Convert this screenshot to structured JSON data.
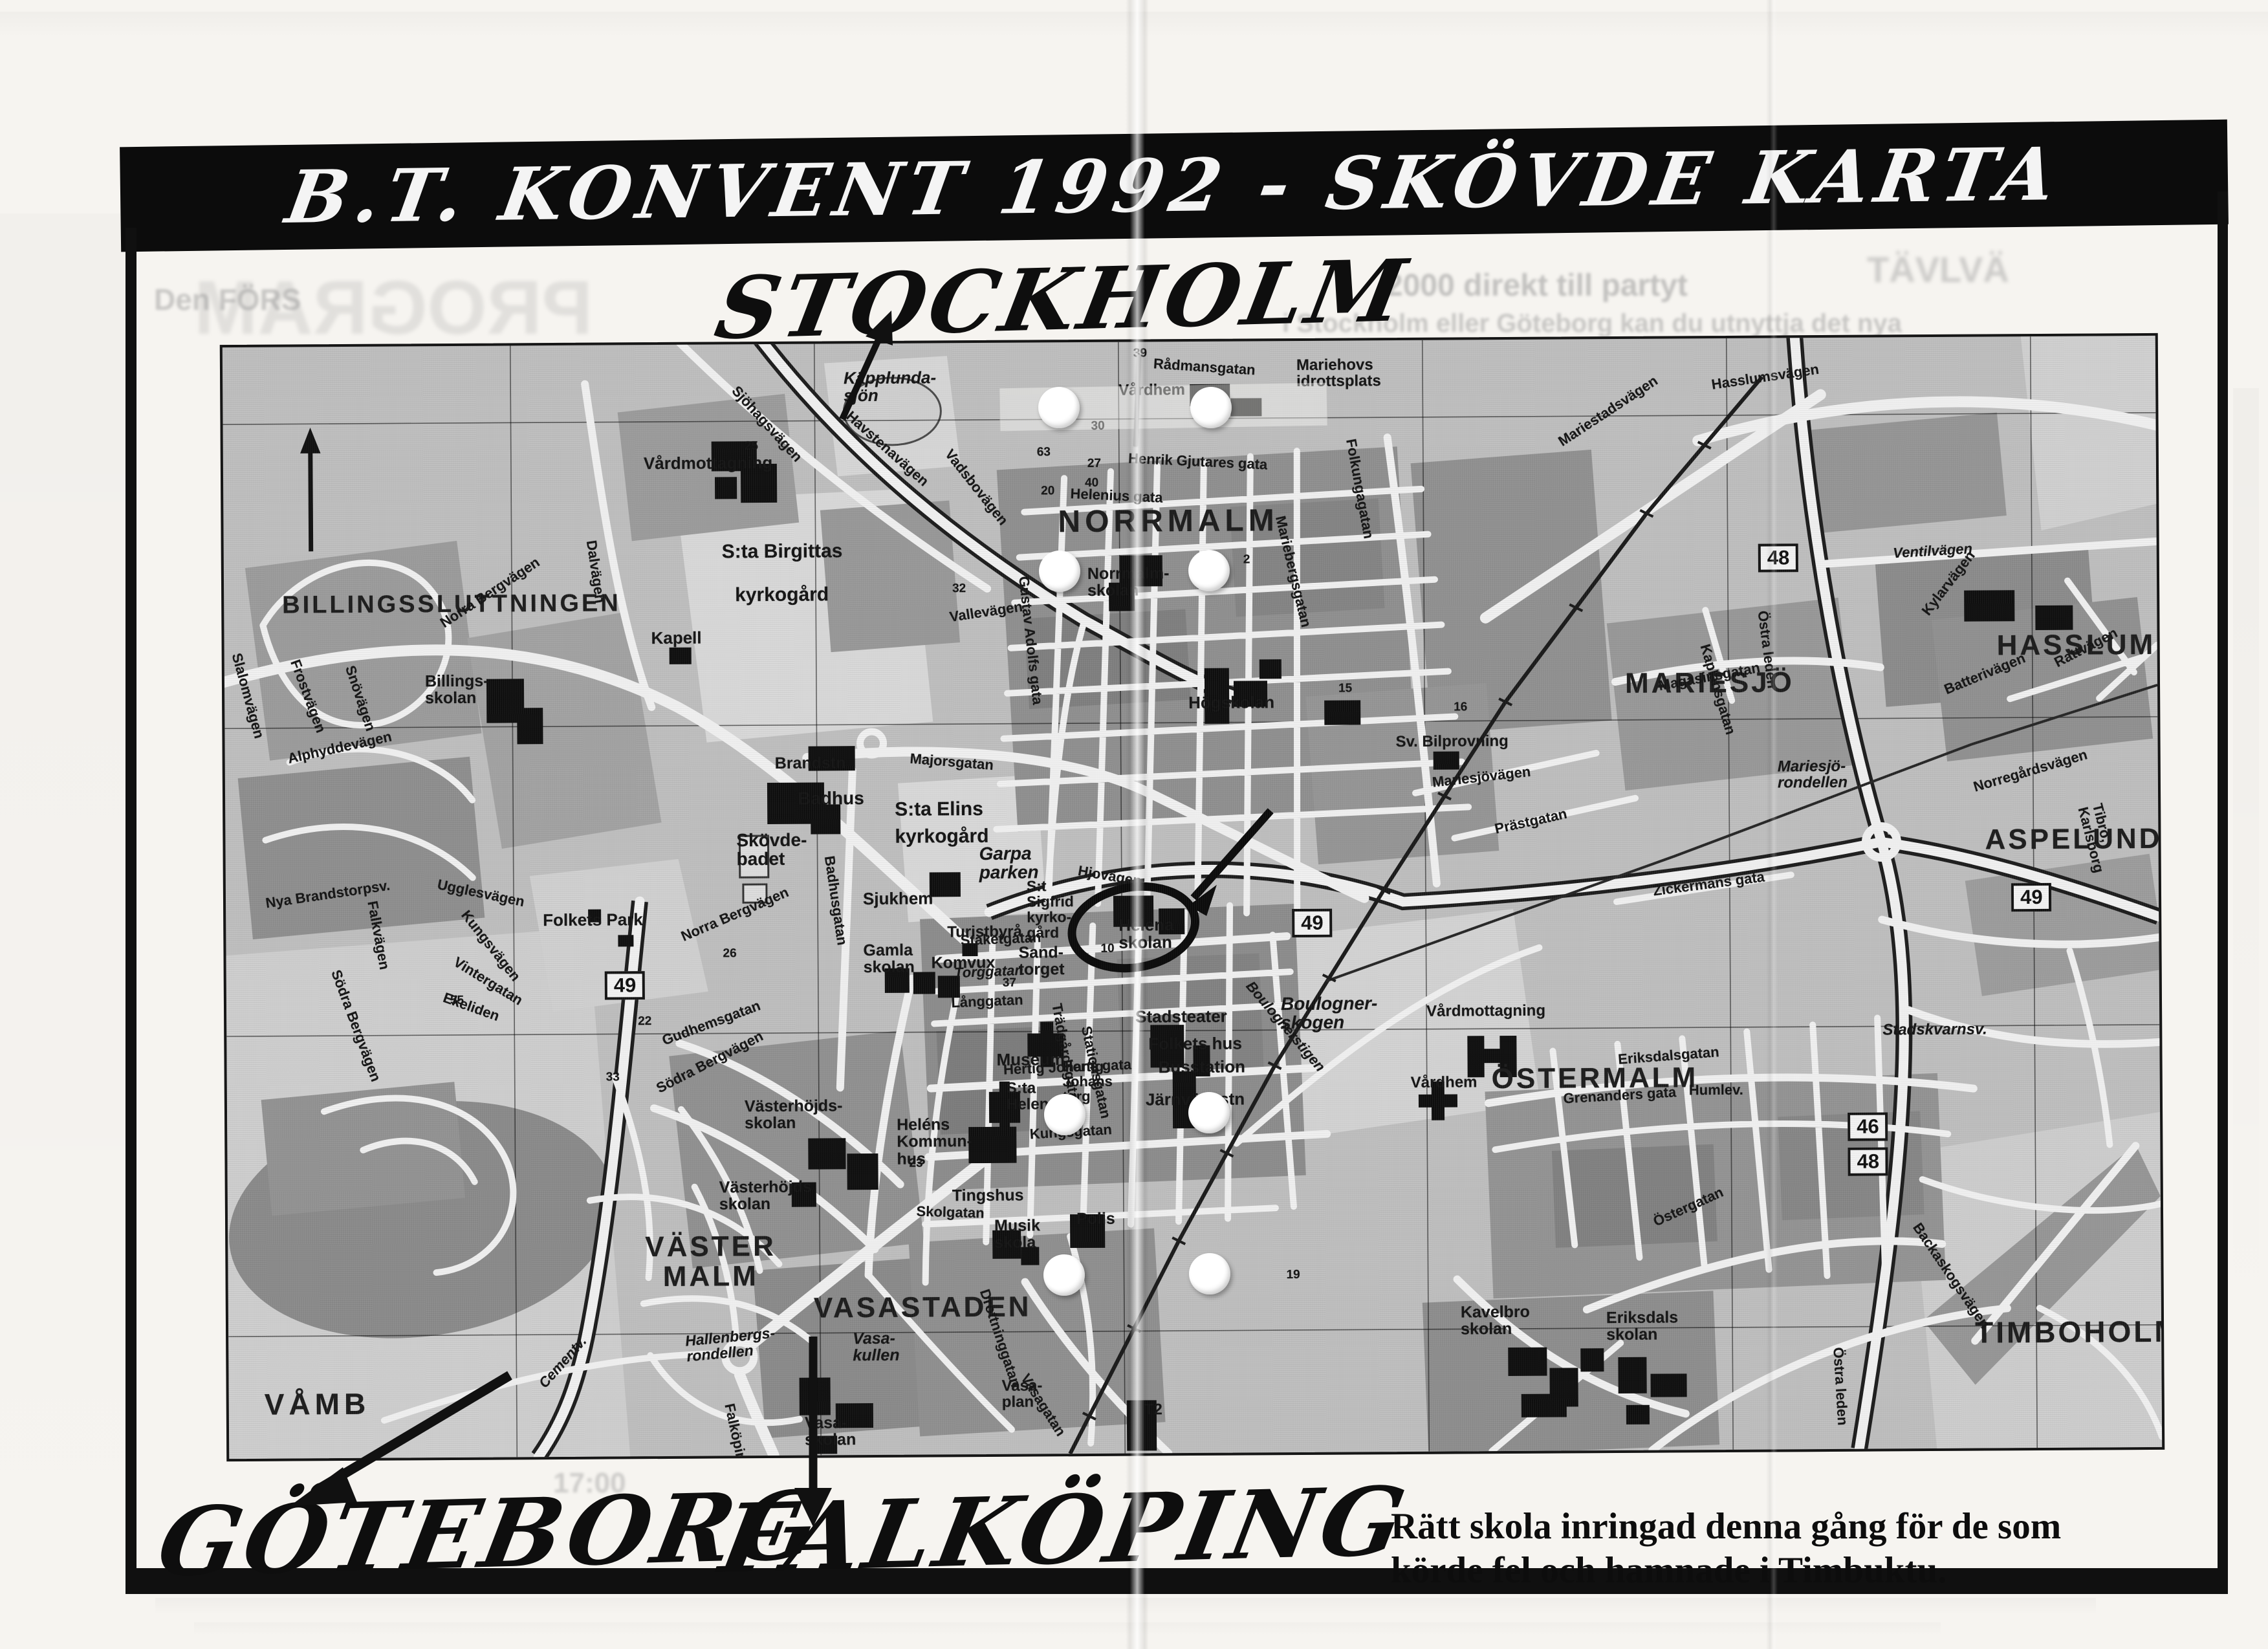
{
  "banner": {
    "title": "B.T. KONVENT 1992 - SKÖVDE KARTA"
  },
  "handwritten": {
    "stockholm": "STOCKHOLM",
    "goteborg": "GÖTEBORG",
    "falkoping": "FALKÖPING"
  },
  "caption": {
    "line1": "Rätt skola inringad denna gång för de som",
    "line2": "körde fel och hamnade i Timbuktu."
  },
  "map": {
    "districts": [
      "BILLINGSSLUTTNINGEN",
      "NORRMALM",
      "MARIESJÖ",
      "HASSLUM",
      "ASPELUND",
      "ÖSTERMALM",
      "TIMBOHOLM",
      "VÄSTER\nMALM",
      "VASASTADEN",
      "VÅMB"
    ],
    "places": [
      "Vårdmottagning",
      "Käpplunda-\nsjön",
      "S:ta Birgittas",
      "kyrkogård",
      "Kapell",
      "Billings-\nskolan",
      "Mariehovs\nidrottsplats",
      "Vårdhem",
      "Norrmalm-\nskolan",
      "Högskolan",
      "Sv. Bilprovning",
      "Mariesjö-\nrondellen",
      "Brandstn",
      "Badhus",
      "Skövde-\nbadet",
      "S:ta Elins\nkyrkogård",
      "Garpa\nparken",
      "Folkets Park",
      "Sjukhem",
      "Turistbyrå",
      "Gamla\nskolan",
      "Komvux",
      "Sand-\ntorget",
      "S:t\nSigfrid\nkyrko-\ngård",
      "Helena\nskolan",
      "Stadsteater",
      "Folkets hus",
      "Busstation",
      "Järnvägsstn",
      "Museum",
      "S:ta\nHelena",
      "Heléns\nKommun-\nhus",
      "Tingshus",
      "Musik\nskola",
      "Polis",
      "Västerhöjds-\nskolan",
      "Västerhöjds\nskolan",
      "Vasa-\nkullen",
      "Vasa-\nskolan",
      "Vasa-\nplan",
      "Boulogner-\nskogen",
      "Vårdmottagning",
      "Vårdhem",
      "Kavelbro\nskolan",
      "Eriksdals\nskolan",
      "Stadskvarnsv.",
      "T2",
      "Hertig\nJohans\ntorg"
    ],
    "streets": [
      "Norra Bergvägen",
      "Slalomvägen",
      "Snövägen",
      "Frostvägen",
      "Alphyddevägen",
      "Dalvägen",
      "Sjöhagsvägen",
      "Havstenavägen",
      "Vadsbovägen",
      "Rådmansgatan",
      "Henrik Gjutares gata",
      "Helenius gata",
      "Gustav Adolfs gata",
      "Folkungagatan",
      "Mariebergsgatan",
      "Mariestadsvägen",
      "Hasslumsvägen",
      "Vallevägen",
      "Majorsgatan",
      "Badhusgatan",
      "Hjovägen",
      "Staketgatan",
      "Torggatan",
      "Långgatan",
      "Kungsgatan",
      "Hertig Johans gata",
      "Drottninggatan",
      "Stationsgatan",
      "Trädgårdsgatan",
      "Skolgatan",
      "Gudhemsgatan",
      "Södra Bergvägen",
      "Nya Brandstorpsv.",
      "Falkvägen",
      "Vintergatan",
      "Ugglesvägen",
      "Kungsvägen",
      "Ekeliden",
      "Falköpingsvägen",
      "Hallenbergs-\nrondellen",
      "Cementv.",
      "Boulognerstigen",
      "Östra leden",
      "Ventilvägen",
      "Kylarvägen",
      "Rattvägen",
      "Batterivägen",
      "Magasinsgatan",
      "Kaplansgatan",
      "Norregårdsvägen",
      "Tibro, Karlsborg",
      "Prästgatan",
      "Mariesjövägen",
      "Eriksdalsgatan",
      "Grenanders gata",
      "Humlev.",
      "Östergatan",
      "Backaskogsvägen",
      "Zickermans gata",
      "Vasagatan"
    ],
    "road_badges": {
      "n48": "48",
      "n49": "49",
      "n46": "46"
    },
    "numbers": [
      "39",
      "30",
      "27",
      "40",
      "63",
      "20",
      "32",
      "25",
      "2",
      "16",
      "26",
      "15",
      "23",
      "19",
      "37",
      "22",
      "33",
      "55",
      "10"
    ]
  },
  "bleed": {
    "top_left_small": "Den FÖRS",
    "top_left_big": "PROGRAM",
    "top_right_1": "2000 direkt till partyt",
    "top_right_2": "TÄVLVÄ",
    "top_right_3": "i Stockholm eller Göteborg kan du utnyttja det nya",
    "bottom_left_time": "17:00"
  }
}
